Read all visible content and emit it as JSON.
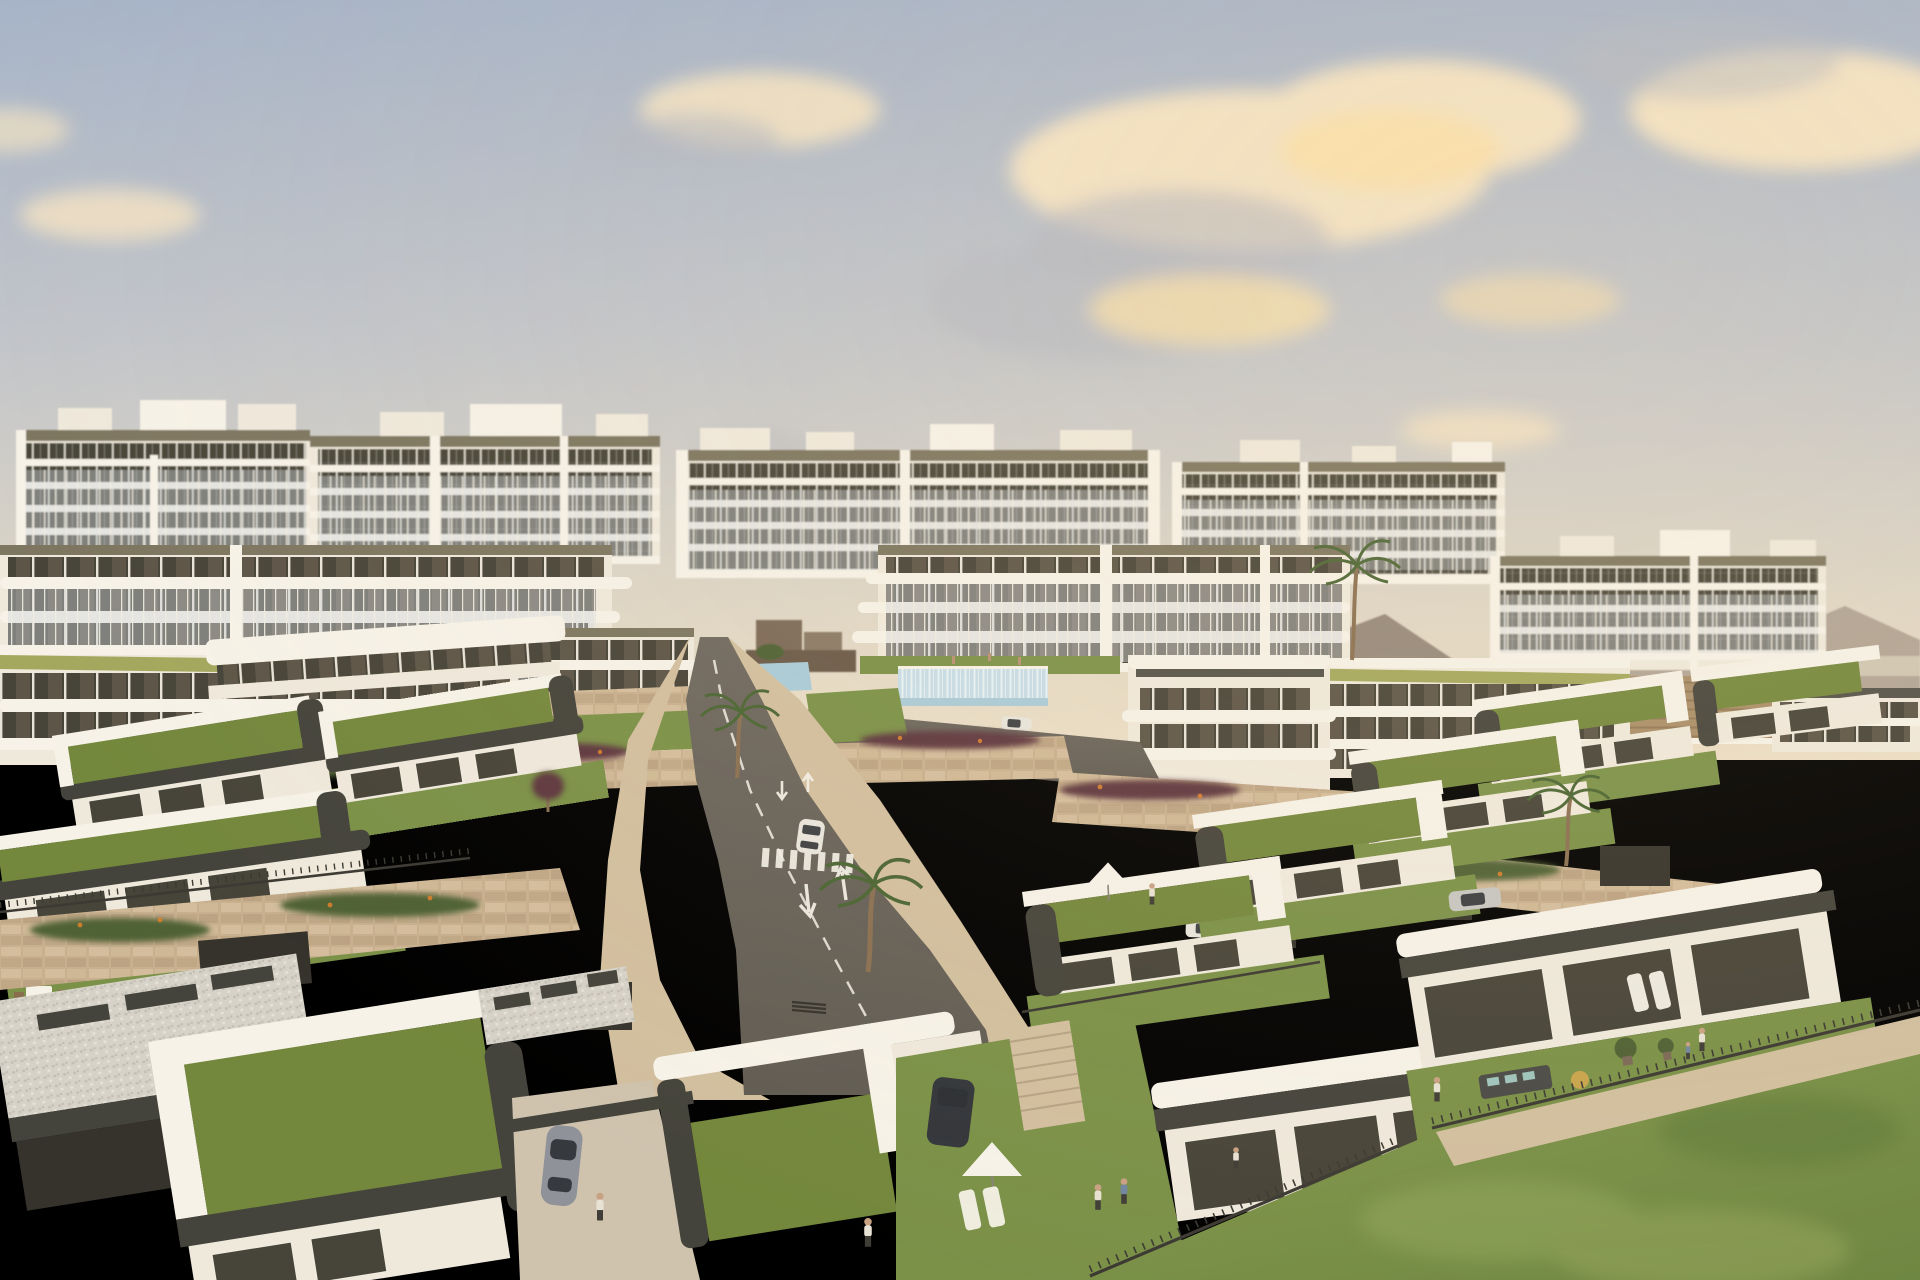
{
  "scene": {
    "title": "Golden-hour aerial render of a hillside residential resort: single-storey villas with planted green roofs in the foreground, terraced white apartment blocks behind, a central road with painted lane arrows and crosswalks, community pool with glass fence, palm trees, stone retaining walls and a large lawn at bottom right",
    "setting": {
      "time_of_day": "golden hour",
      "weather": "partly cloudy",
      "environment": "Mediterranean hillside development"
    },
    "background": {
      "apartment_blocks": 5,
      "features": [
        "white balcony slab bands",
        "rooftop penthouse boxes",
        "balcony plants",
        "hazy mountains on the right",
        "distant small houses",
        "brown planted field with rows",
        "tiny playground"
      ]
    },
    "midground": {
      "buildings": [
        "stepped apartment terraces with olive-green roofline bands",
        "clubhouse with rounded white balcony bands"
      ],
      "pool_glass_fence": true,
      "stone_retaining_walls": true,
      "flowering_planters": [
        "red-purple shrubs",
        "orange flowers"
      ]
    },
    "foreground": {
      "villa_style": "modern single-storey, planted green roof, white L-shaped parapet, dark olive fascia, glass sliding doors",
      "garden_items": [
        "white parasols",
        "sun loungers",
        "outdoor sofa sets",
        "dining table",
        "potted trees"
      ],
      "people_count": 14,
      "palm_trees": 4
    },
    "road": {
      "lane_arrows": [
        "down",
        "up"
      ],
      "crosswalks": 2,
      "dashed_center_line": true,
      "drain_grate": true,
      "side_branch_road": true
    },
    "vehicles": {
      "cars_on_road": 2,
      "parked_cars": 5,
      "types": [
        "white hatchback",
        "blue sedan",
        "dark blue sedan",
        "black SUV",
        "grey sports car",
        "silver car"
      ]
    },
    "lawn": {
      "position": "bottom-right",
      "stone_path": true,
      "metal_fence": true
    }
  },
  "palette": {
    "sky_top": "#a7b4c8",
    "sky_mid": "#c2c5ca",
    "sky_low": "#ded6c6",
    "sky_horizon": "#ecdfc6",
    "cloud_warm": "#f2e2c4",
    "cloud_bright": "#f8e0ab",
    "cloud_gray": "#b4b8c1",
    "mountain": "#8d7f73",
    "mountain_far": "#a89b8d",
    "white_hi": "#f6f2e8",
    "white": "#efe9dc",
    "white_shade": "#dcd4c4",
    "fascia": "#7d7660",
    "fascia_dark": "#54524a",
    "fascia_deep": "#45443c",
    "glass_dark": "#474439",
    "glass_warm": "#6e6354",
    "glass_black": "#35332c",
    "balcony": "#cdd4d8",
    "mullion": "#f1ede1",
    "green_band": "#a3a85e",
    "stone": "#c8b08f",
    "stone_light": "#dbc5a4",
    "stone_dark": "#ad9373",
    "grass_roof": "#74883d",
    "grass": "#7b9148",
    "lawn": "#85994d",
    "lawn_dark": "#6e8742",
    "road": "#615c53",
    "road_hi": "#6f6960",
    "paving": "#d2bf9f",
    "concrete": "#cfc3ae",
    "gravel": "#d6d2c8",
    "fence": "#3c3a33",
    "marking": "#f2efe6",
    "pool": "#a9cbd9",
    "pool_glass": "#c6dde8",
    "glass_stripe": "#e9f2f6",
    "shrub_red": "#5e3740",
    "shrub": "#4f6234",
    "flower_orange": "#d97f2e",
    "palm": "#4b6534",
    "trunk": "#8a7052",
    "car_white": "#e8e5dd",
    "car_blue": "#47597a",
    "car_dark": "#33363b",
    "car_gray": "#8f9298",
    "car_silver": "#c7c6c2",
    "person_light": "#e8e2d4",
    "person_dark": "#3f3d36",
    "person_blue": "#7286a0",
    "field": "#a98e6a",
    "town": "#7b6a58",
    "overlay_warm": "#ffdca8"
  }
}
